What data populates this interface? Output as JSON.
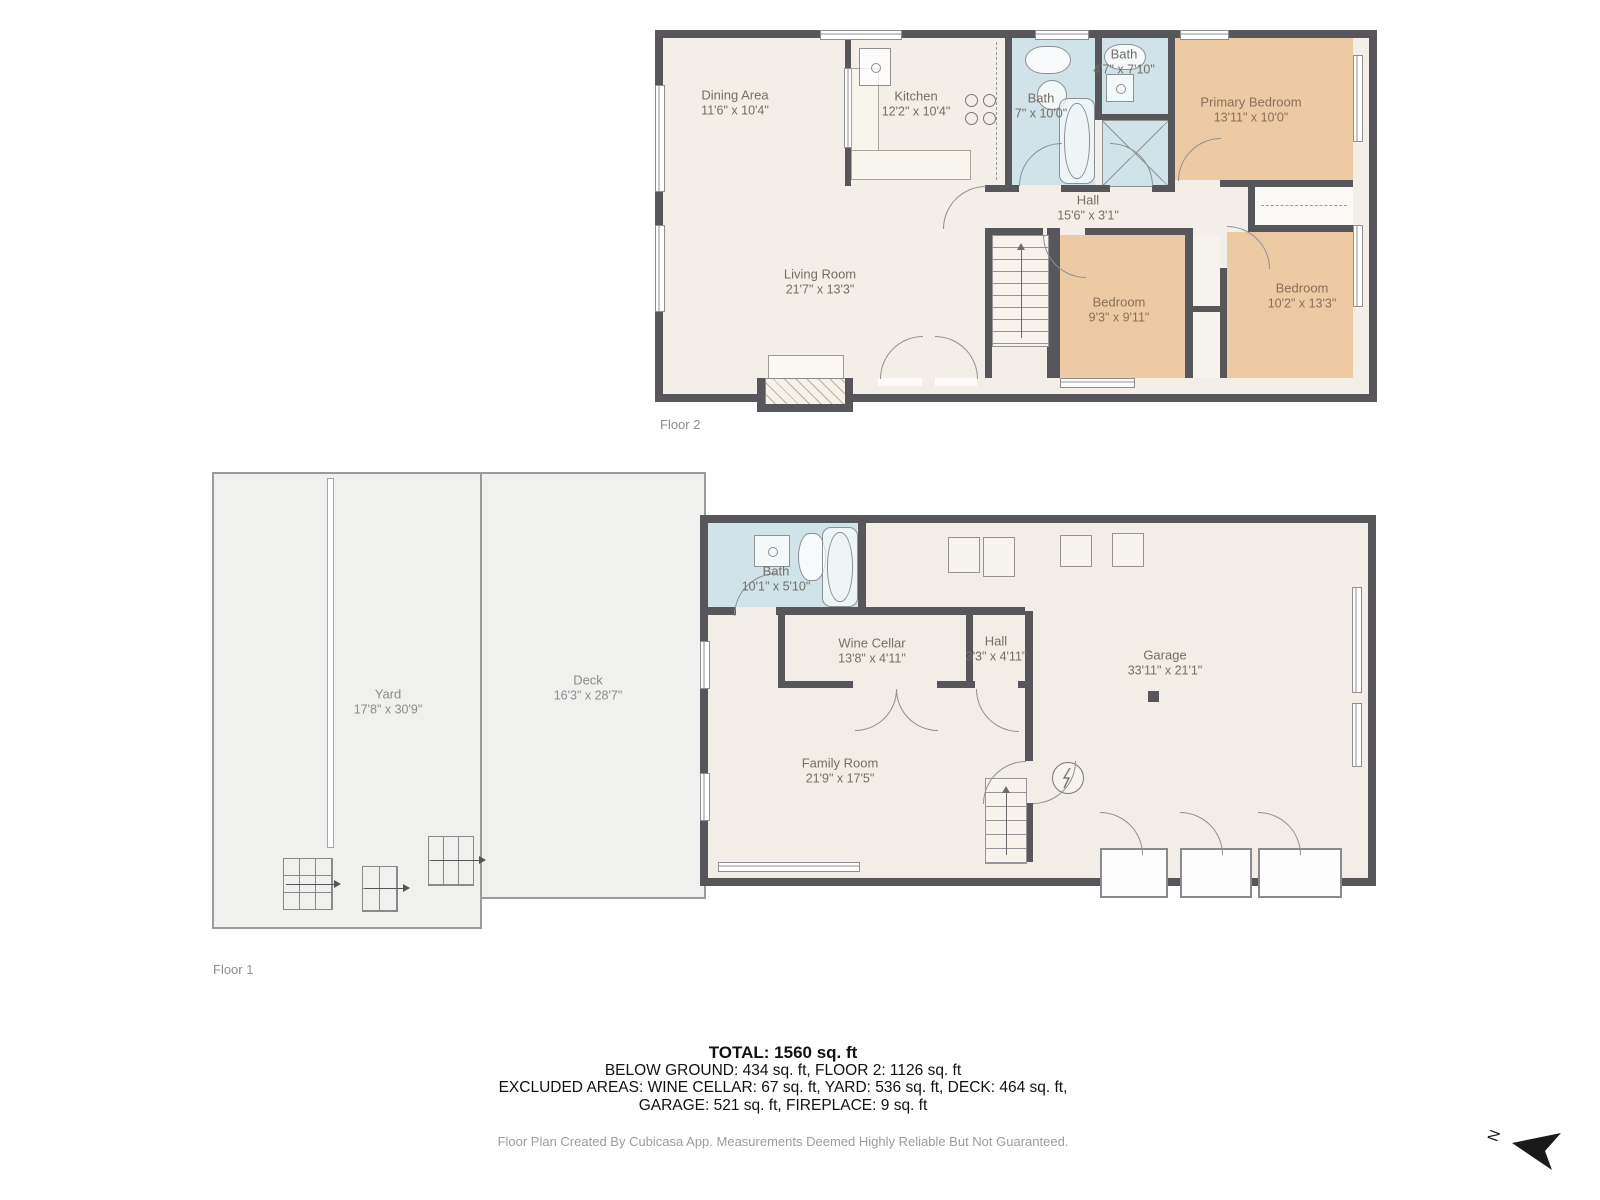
{
  "floor2": {
    "label": "Floor 2",
    "rooms": {
      "dining": {
        "name": "Dining Area",
        "dims": "11'6\" x 10'4\""
      },
      "kitchen": {
        "name": "Kitchen",
        "dims": "12'2\" x 10'4\""
      },
      "bath_main": {
        "name": "Bath",
        "dims": "7\" x 10'0\""
      },
      "bath_ensuite": {
        "name": "Bath",
        "dims": "4'7\" x 7'10\""
      },
      "primary": {
        "name": "Primary Bedroom",
        "dims": "13'11\" x 10'0\""
      },
      "hall": {
        "name": "Hall",
        "dims": "15'6\" x 3'1\""
      },
      "living": {
        "name": "Living Room",
        "dims": "21'7\" x 13'3\""
      },
      "bedroom_mid": {
        "name": "Bedroom",
        "dims": "9'3\" x 9'11\""
      },
      "bedroom_right": {
        "name": "Bedroom",
        "dims": "10'2\" x 13'3\""
      }
    }
  },
  "floor1": {
    "label": "Floor 1",
    "rooms": {
      "yard": {
        "name": "Yard",
        "dims": "17'8\" x 30'9\""
      },
      "deck": {
        "name": "Deck",
        "dims": "16'3\" x 28'7\""
      },
      "bath": {
        "name": "Bath",
        "dims": "10'1\" x 5'10\""
      },
      "wine_cellar": {
        "name": "Wine Cellar",
        "dims": "13'8\" x 4'11\""
      },
      "hall": {
        "name": "Hall",
        "dims": "3'3\" x 4'11\""
      },
      "family": {
        "name": "Family Room",
        "dims": "21'9\" x 17'5\""
      },
      "garage": {
        "name": "Garage",
        "dims": "33'11\" x 21'1\""
      }
    }
  },
  "summary": {
    "total": "TOTAL: 1560 sq. ft",
    "line1": "BELOW GROUND: 434 sq. ft, FLOOR 2: 1126 sq. ft",
    "line2": "EXCLUDED AREAS: WINE CELLAR: 67 sq. ft, YARD: 536 sq. ft, DECK: 464 sq. ft,",
    "line3": "GARAGE: 521 sq. ft, FIREPLACE: 9 sq. ft"
  },
  "footer": "Floor Plan Created By Cubicasa App. Measurements Deemed Highly Reliable But Not Guaranteed.",
  "north": {
    "label": "N"
  },
  "colors": {
    "wall": "#57575b",
    "floor": "#f3eee7",
    "bedroom": "#edc9a4",
    "bath": "#cfe3e8",
    "outdoor": "#f0f0ef"
  }
}
